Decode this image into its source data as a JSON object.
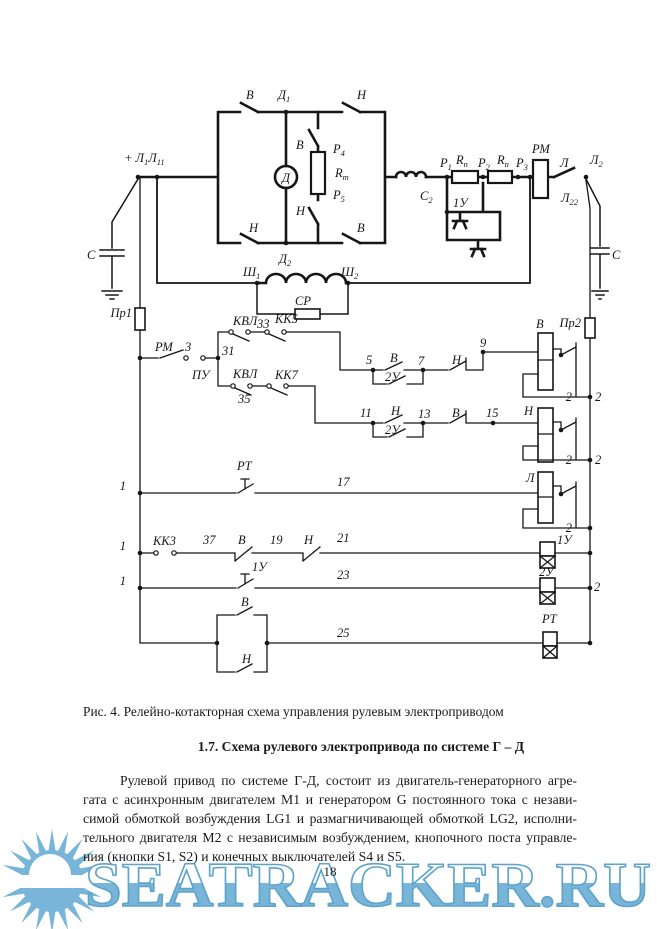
{
  "figure": {
    "caption": "Рис. 4. Релейно-котакторная схема управления рулевым электроприводом"
  },
  "section": {
    "heading": "1.7. Схема рулевого электропривода по системе Г – Д"
  },
  "paragraph": {
    "lines": [
      "Рулевой привод по системе Г-Д, состоит из двигатель-генераторного агре-",
      "гата с асинхронным двигателем М1 и генератором G постоянного тока с незави-",
      "симой обмоткой возбуждения LG1 и размагничивающей обмоткой LG2, исполни-",
      "тельного двигателя М2 с независимым возбуждением, кнопочного поста управле-",
      "ния (кнопки S1, S2) и конечных выключателей S4 и S5."
    ]
  },
  "page_number": "18",
  "watermark": {
    "text": "SEATRACKER.RU",
    "color": "#79b5d8",
    "stroke": "#5ea3cc"
  },
  "schematic": {
    "ink": "#161616",
    "labels": [
      {
        "x": 246,
        "y": 99,
        "t": "В"
      },
      {
        "x": 278,
        "y": 99,
        "parts": [
          {
            "t": "Д",
            "sub": "1"
          }
        ]
      },
      {
        "x": 357,
        "y": 99,
        "t": "Н"
      },
      {
        "x": 124,
        "y": 162,
        "parts": [
          {
            "t": "+ Л",
            "sub": "1"
          },
          {
            "t": "Л",
            "sub": "11"
          }
        ]
      },
      {
        "x": 296,
        "y": 149,
        "t": "В"
      },
      {
        "x": 333,
        "y": 153,
        "parts": [
          {
            "t": "Р",
            "sub": "4"
          }
        ]
      },
      {
        "x": 335,
        "y": 177,
        "parts": [
          {
            "t": "R",
            "sub": "т"
          }
        ]
      },
      {
        "x": 333,
        "y": 199,
        "parts": [
          {
            "t": "Р",
            "sub": "5"
          }
        ]
      },
      {
        "x": 296,
        "y": 215,
        "t": "Н"
      },
      {
        "x": 249,
        "y": 232,
        "t": "Н"
      },
      {
        "x": 279,
        "y": 263,
        "parts": [
          {
            "t": "Д",
            "sub": "2"
          }
        ]
      },
      {
        "x": 357,
        "y": 232,
        "t": "В"
      },
      {
        "x": 87,
        "y": 259,
        "t": "С"
      },
      {
        "x": 286,
        "y": 182,
        "t": "Д",
        "a": "middle"
      },
      {
        "x": 243,
        "y": 276,
        "parts": [
          {
            "t": "Ш",
            "sub": "1"
          }
        ]
      },
      {
        "x": 341,
        "y": 276,
        "parts": [
          {
            "t": "Ш",
            "sub": "2"
          }
        ]
      },
      {
        "x": 295,
        "y": 305,
        "t": "СР"
      },
      {
        "x": 440,
        "y": 167,
        "parts": [
          {
            "t": "Р",
            "sub": "1"
          }
        ]
      },
      {
        "x": 456,
        "y": 164,
        "parts": [
          {
            "t": "R",
            "sub": "п"
          }
        ]
      },
      {
        "x": 478,
        "y": 167,
        "parts": [
          {
            "t": "Р",
            "sub": "2"
          }
        ]
      },
      {
        "x": 497,
        "y": 164,
        "parts": [
          {
            "t": "R",
            "sub": "п"
          }
        ]
      },
      {
        "x": 516,
        "y": 167,
        "parts": [
          {
            "t": "Р",
            "sub": "3"
          }
        ]
      },
      {
        "x": 532,
        "y": 153,
        "t": "РМ"
      },
      {
        "x": 560,
        "y": 167,
        "t": "Л"
      },
      {
        "x": 590,
        "y": 164,
        "parts": [
          {
            "t": "Л",
            "sub": "2"
          }
        ]
      },
      {
        "x": 561,
        "y": 202,
        "parts": [
          {
            "t": "Л",
            "sub": "22"
          }
        ]
      },
      {
        "x": 420,
        "y": 200,
        "parts": [
          {
            "t": "С",
            "sub": "2"
          }
        ]
      },
      {
        "x": 453,
        "y": 207,
        "t": "1У"
      },
      {
        "x": 612,
        "y": 259,
        "t": "С"
      },
      {
        "x": 132,
        "y": 317,
        "t": "Пр1",
        "a": "end"
      },
      {
        "x": 581,
        "y": 327,
        "t": "Пр2",
        "a": "end"
      },
      {
        "x": 155,
        "y": 351,
        "t": "РМ"
      },
      {
        "x": 185,
        "y": 351,
        "t": "3"
      },
      {
        "x": 192,
        "y": 379,
        "t": "ПУ"
      },
      {
        "x": 222,
        "y": 355,
        "t": "31"
      },
      {
        "x": 233,
        "y": 325,
        "t": "КВЛ"
      },
      {
        "x": 257,
        "y": 328,
        "t": "33"
      },
      {
        "x": 275,
        "y": 323,
        "t": "КК5"
      },
      {
        "x": 233,
        "y": 378,
        "t": "КВЛ"
      },
      {
        "x": 238,
        "y": 403,
        "t": "35"
      },
      {
        "x": 275,
        "y": 379,
        "t": "КК7"
      },
      {
        "x": 366,
        "y": 364,
        "t": "5"
      },
      {
        "x": 390,
        "y": 362,
        "t": "В"
      },
      {
        "x": 385,
        "y": 381,
        "t": "2У"
      },
      {
        "x": 418,
        "y": 365,
        "t": "7"
      },
      {
        "x": 452,
        "y": 364,
        "t": "Н"
      },
      {
        "x": 480,
        "y": 347,
        "t": "9"
      },
      {
        "x": 360,
        "y": 417,
        "t": "11"
      },
      {
        "x": 391,
        "y": 415,
        "t": "Н"
      },
      {
        "x": 385,
        "y": 434,
        "t": "2У"
      },
      {
        "x": 418,
        "y": 418,
        "t": "13"
      },
      {
        "x": 452,
        "y": 417,
        "t": "В"
      },
      {
        "x": 486,
        "y": 417,
        "t": "15"
      },
      {
        "x": 524,
        "y": 415,
        "t": "Н"
      },
      {
        "x": 536,
        "y": 328,
        "t": "В"
      },
      {
        "x": 526,
        "y": 482,
        "t": "Л"
      },
      {
        "x": 237,
        "y": 470,
        "t": "РТ"
      },
      {
        "x": 337,
        "y": 486,
        "t": "17"
      },
      {
        "x": 126,
        "y": 490,
        "t": "1",
        "a": "end"
      },
      {
        "x": 153,
        "y": 545,
        "t": "КК3"
      },
      {
        "x": 203,
        "y": 544,
        "t": "37"
      },
      {
        "x": 238,
        "y": 544,
        "t": "В"
      },
      {
        "x": 270,
        "y": 544,
        "t": "19"
      },
      {
        "x": 304,
        "y": 544,
        "t": "Н"
      },
      {
        "x": 337,
        "y": 542,
        "t": "21"
      },
      {
        "x": 126,
        "y": 550,
        "t": "1",
        "a": "end"
      },
      {
        "x": 252,
        "y": 571,
        "t": "1У"
      },
      {
        "x": 337,
        "y": 579,
        "t": "23"
      },
      {
        "x": 126,
        "y": 585,
        "t": "1",
        "a": "end"
      },
      {
        "x": 241,
        "y": 606,
        "t": "В"
      },
      {
        "x": 242,
        "y": 663,
        "t": "Н"
      },
      {
        "x": 337,
        "y": 637,
        "t": "25"
      },
      {
        "x": 557,
        "y": 544,
        "t": "1У"
      },
      {
        "x": 539,
        "y": 576,
        "t": "2У"
      },
      {
        "x": 542,
        "y": 623,
        "t": "РТ"
      },
      {
        "x": 572,
        "y": 401,
        "t": "2",
        "a": "end"
      },
      {
        "x": 595,
        "y": 401,
        "t": "2"
      },
      {
        "x": 572,
        "y": 464,
        "t": "2",
        "a": "end"
      },
      {
        "x": 595,
        "y": 464,
        "t": "2"
      },
      {
        "x": 572,
        "y": 532,
        "t": "2",
        "a": "end"
      },
      {
        "x": 594,
        "y": 591,
        "t": "2"
      }
    ]
  }
}
